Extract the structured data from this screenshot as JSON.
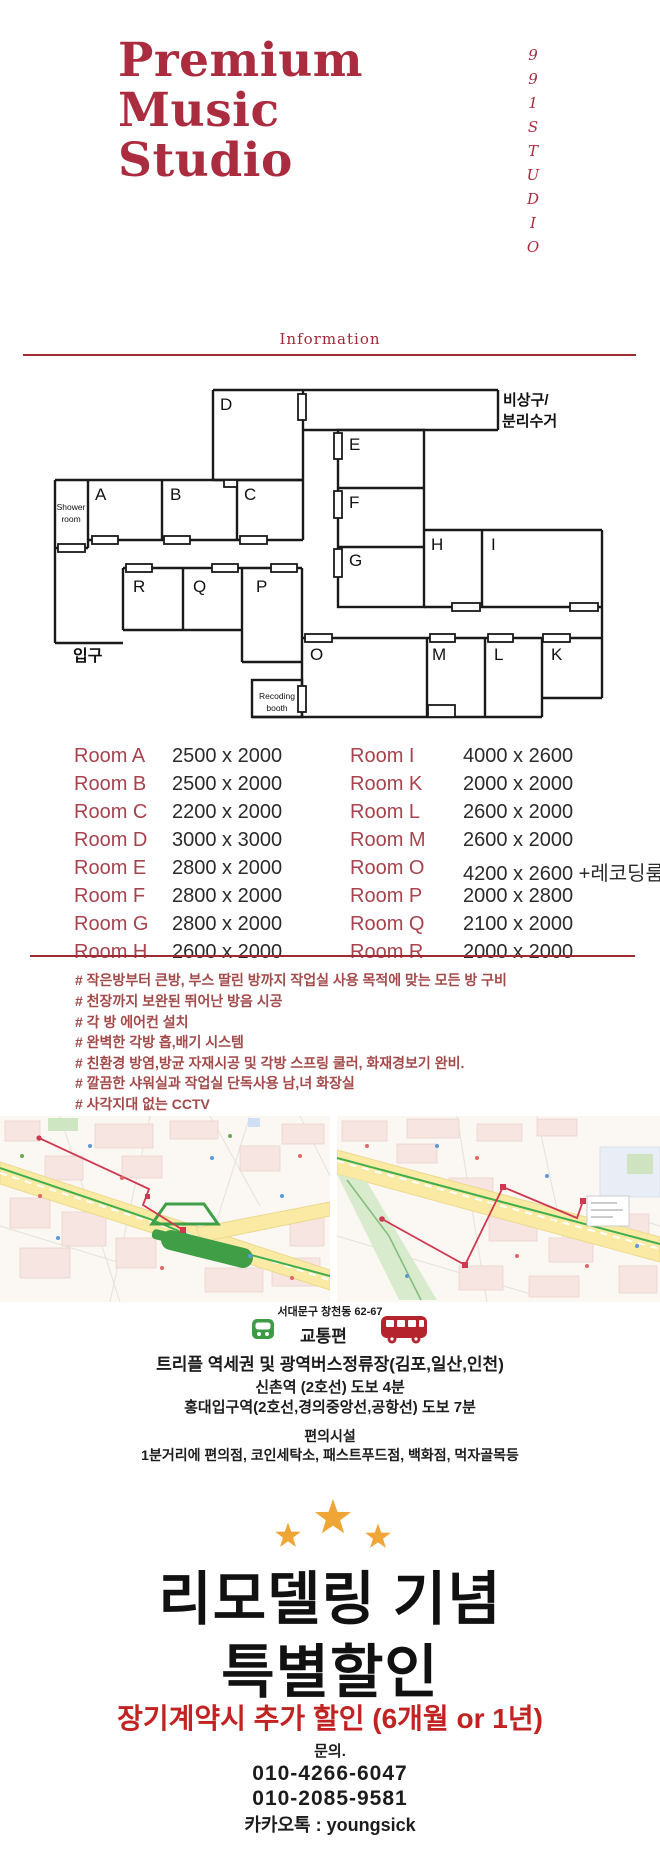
{
  "header": {
    "title_lines": [
      "Premium",
      "Music",
      "Studio"
    ],
    "vertical_text": "991STUDIO"
  },
  "info": {
    "heading": "Information"
  },
  "floorplan": {
    "labels": {
      "a": "A",
      "b": "B",
      "c": "C",
      "d": "D",
      "e": "E",
      "f": "F",
      "g": "G",
      "h": "H",
      "i": "I",
      "k": "K",
      "l": "L",
      "m": "M",
      "o": "O",
      "p": "P",
      "q": "Q",
      "r": "R"
    },
    "shower": [
      "Shower",
      "room"
    ],
    "booth": [
      "Recoding",
      "booth"
    ],
    "exit": [
      "비상구/",
      "분리수거"
    ],
    "entrance": "입구"
  },
  "room_table": {
    "left": [
      {
        "room": "Room A",
        "size": "2500 x 2000"
      },
      {
        "room": "Room B",
        "size": "2500 x 2000"
      },
      {
        "room": "Room C",
        "size": "2200 x 2000"
      },
      {
        "room": "Room D",
        "size": "3000 x 3000"
      },
      {
        "room": "Room E",
        "size": "2800 x 2000"
      },
      {
        "room": "Room F",
        "size": "2800 x 2000"
      },
      {
        "room": "Room G",
        "size": "2800 x 2000"
      },
      {
        "room": "Room H",
        "size": "2600 x 2000"
      }
    ],
    "right": [
      {
        "room": "Room I",
        "size": "4000 x 2600"
      },
      {
        "room": "Room K",
        "size": "2000 x 2000"
      },
      {
        "room": "Room L",
        "size": "2600 x 2000"
      },
      {
        "room": "Room M",
        "size": "2600 x 2000"
      },
      {
        "room": "Room O",
        "size": "4200 x 2600 +레코딩룸"
      },
      {
        "room": "Room P",
        "size": "2000 x 2800"
      },
      {
        "room": "Room Q",
        "size": "2100 x 2000"
      },
      {
        "room": "Room R",
        "size": "2000 x 2000"
      }
    ]
  },
  "features": [
    "# 작은방부터 큰방, 부스 딸린 방까지 작업실 사용 목적에 맞는 모든 방 구비",
    "# 천장까지 보완된 뛰어난 방음 시공",
    "# 각 방 에어컨 설치",
    "# 완벽한 각방 흡,배기 시스템",
    "# 친환경 방염,방균 자재시공 및 각방 스프링 쿨러, 화재경보기 완비.",
    "# 깔끔한 샤워실과 작업실 단독사용 남,녀 화장실",
    "# 사각지대 없는 CCTV"
  ],
  "location": {
    "address": "서대문구 창천동 62-67",
    "transport_heading": "교통편",
    "transport_lines": [
      "트리플 역세권 및 광역버스정류장(김포,일산,인천)",
      "신촌역 (2호선) 도보 4분",
      "홍대입구역(2호선,경의중앙선,공항선) 도보 7분"
    ],
    "amenities_heading": "편의시설",
    "amenities_line": "1분거리에 편의점, 코인세탁소, 패스트푸드점, 백화점, 먹자골목등"
  },
  "promo": {
    "line1": "리모델링 기념",
    "line2": "특별할인",
    "discount": "장기계약시 추가 할인 (6개월 or 1년)",
    "contact_label": "문의.",
    "phone1": "010-4266-6047",
    "phone2": "010-2085-9581",
    "kakao": "카카오톡 : youngsick"
  },
  "colors": {
    "brand_red": "#ab2b3f",
    "rule_red": "#9e2b33",
    "table_label_red": "#a8434e",
    "feature_red": "#a34a4a",
    "promo_red": "#c32222",
    "text_black": "#1c1c1c",
    "star_gold": "#f0a636",
    "subway_green": "#3d9b45",
    "bus_red": "#b5242c",
    "map_road_yellow": "#fbeaa4",
    "map_route_red": "#cf3850",
    "map_station_green": "#3f9e46"
  }
}
